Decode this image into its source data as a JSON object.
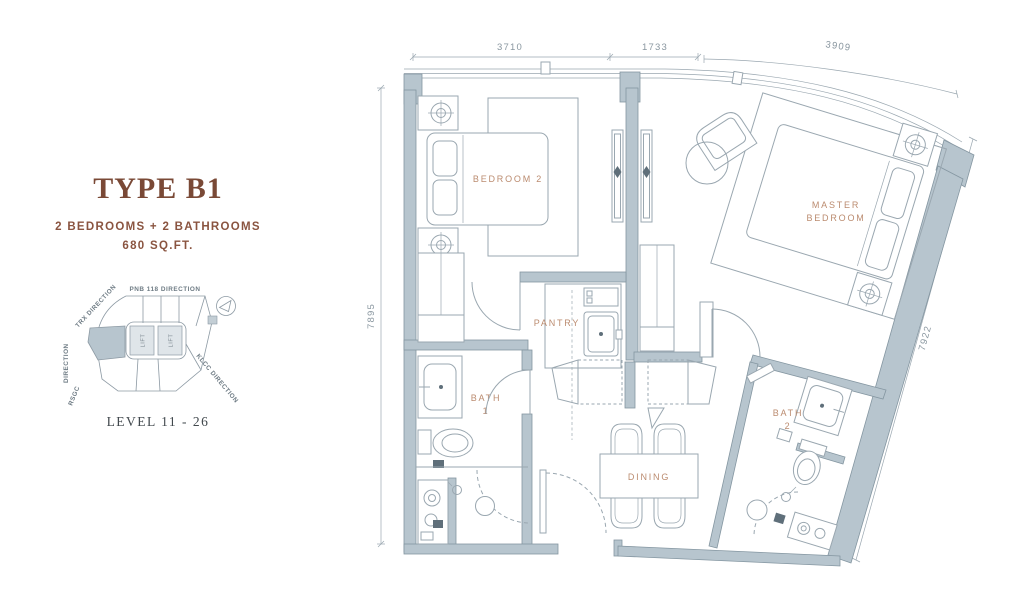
{
  "info_panel": {
    "title": "TYPE B1",
    "subtitle": "2 BEDROOMS + 2 BATHROOMS",
    "area": "680 SQ.FT.",
    "level": "LEVEL 11 - 26",
    "key_plan": {
      "direction_top": "PNB 118 DIRECTION",
      "direction_upper_left": "TRX DIRECTION",
      "direction_left": "DIRECTION",
      "direction_left_bottom": "RSGC",
      "direction_lower_right": "KLCC DIRECTION",
      "lift_1": "LIFT",
      "lift_2": "LIFT",
      "north_arrow_icon": "compass-north-arrow"
    }
  },
  "floor_plan": {
    "rooms": {
      "bedroom2": "BEDROOM 2",
      "master_line1": "MASTER",
      "master_line2": "BEDROOM",
      "pantry": "PANTRY",
      "bath1_line1": "BATH",
      "bath1_line2": "1",
      "bath2_line1": "BATH",
      "bath2_line2": "2",
      "dining": "DINING"
    },
    "dimensions": {
      "top_left": "3710",
      "top_middle": "1733",
      "top_right": "3909",
      "left": "7895",
      "right": "7922"
    }
  },
  "colors": {
    "wall_fill": "#b7c5ce",
    "wall_stroke": "#8496a1",
    "furniture_line": "#9aa7b0",
    "room_label": "#bb8b6f",
    "dimension_text": "#8a97a0",
    "title_text": "#7a4936",
    "subtitle_text": "#8a5440",
    "level_text": "#41484d"
  }
}
